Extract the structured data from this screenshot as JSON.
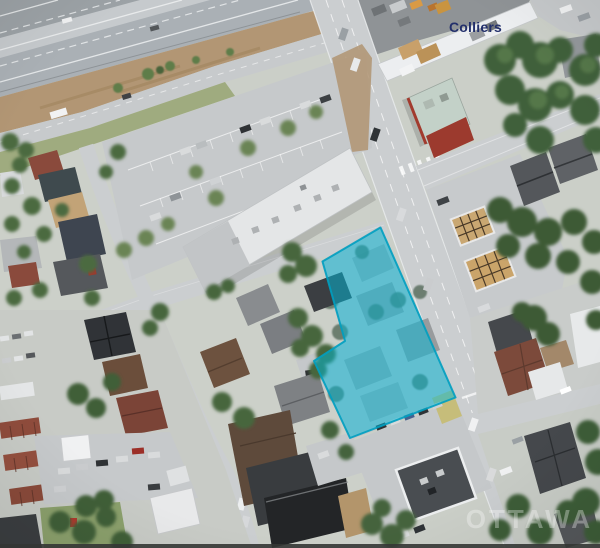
{
  "branding": {
    "logo_text": "Colliers",
    "logo_color": "#222f6b"
  },
  "watermark": {
    "text": "OTTAWA",
    "color": "#ffffff"
  },
  "parcel_highlight": {
    "fill": "#00b9da",
    "stroke": "#009fc0"
  }
}
